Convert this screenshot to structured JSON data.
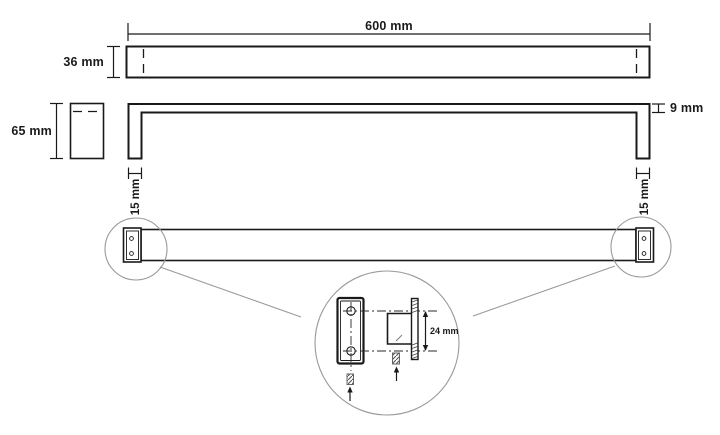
{
  "drawing": {
    "labels": {
      "length": "600 mm",
      "profile_height": "36 mm",
      "bracket_depth": "65 mm",
      "bar_thickness": "9 mm",
      "post_width_left": "15 mm",
      "post_width_right": "15 mm",
      "hole_spacing": "24 mm"
    },
    "colors": {
      "line": "#1a1a1a",
      "annotation": "#999999",
      "background": "#ffffff"
    }
  }
}
